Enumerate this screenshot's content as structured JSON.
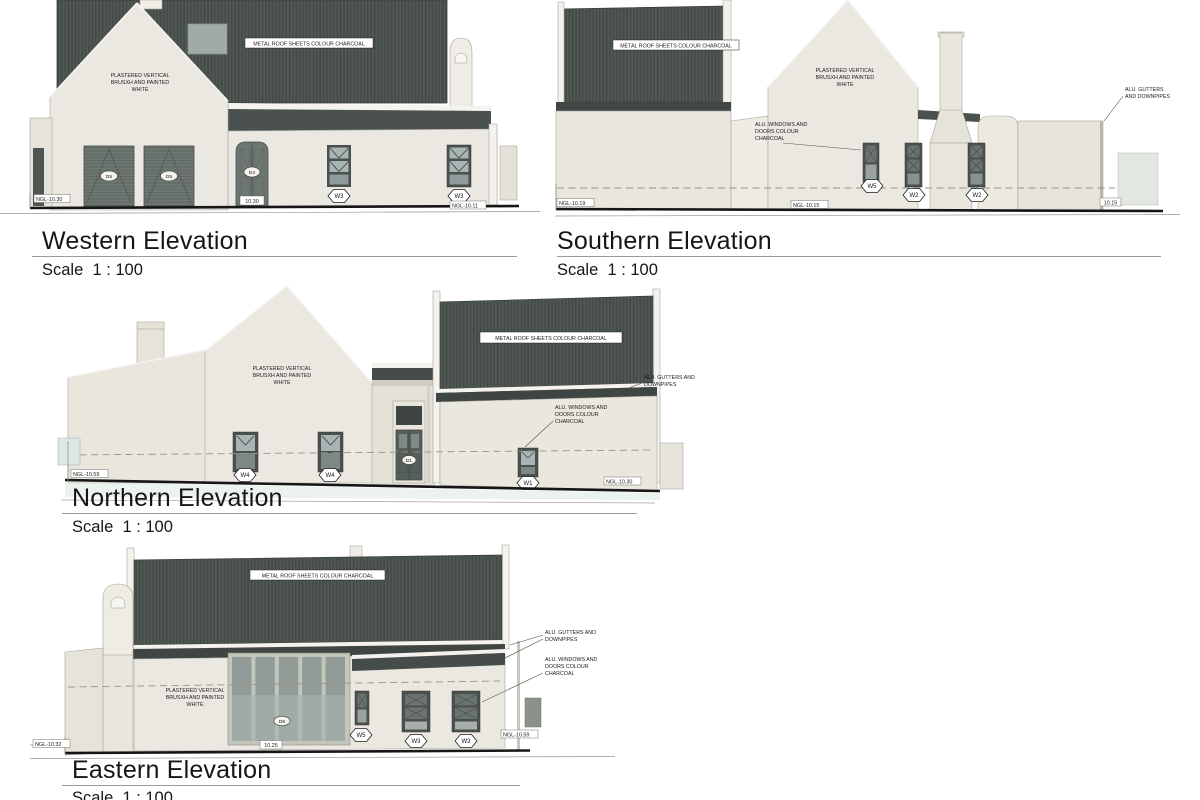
{
  "page": {
    "background": "#ffffff"
  },
  "palette": {
    "roof": "#4d5450",
    "roof_rib": "#404744",
    "eave": "#3f4542",
    "wall": "#ebe8e1",
    "wall_light": "#f3f2ec",
    "wall_shade": "#e3e0d7",
    "frame": "#49504d",
    "door_gray": "#6e7672",
    "glass_light": "#a9b4b4",
    "glass_dark": "#6a7370",
    "skylight": "#9faca5",
    "ground_line": "#161616",
    "ground_tint": "#d9e7e0"
  },
  "elevations": {
    "western": {
      "title": "Western Elevation",
      "scale_label": "Scale  1 : 100",
      "roof_note": "METAL ROOF SHEETS COLOUR CHARCOAL",
      "wall_note": [
        "PLASTERED VERTICAL",
        "BRUSXH AND PAINTED",
        "WHITE"
      ],
      "tags": {
        "garage_left": "D5",
        "garage_right": "D5",
        "door": "D4",
        "door_level": "10.30",
        "window_left": "W3",
        "window_right": "W3"
      },
      "levels": {
        "left": "NGL-10.30",
        "right": "NGL-10.11"
      }
    },
    "southern": {
      "title": "Southern Elevation",
      "scale_label": "Scale  1 : 100",
      "roof_note": "METAL ROOF SHEETS COLOUR CHARCOAL",
      "windows_note": [
        "ALU. WINDOWS AND",
        "DOORS COLOUR",
        "CHARCOAL"
      ],
      "wall_note": [
        "PLASTERED VERTICAL",
        "BRUSXH AND PAINTED",
        "WHITE"
      ],
      "gutters_note": [
        "ALU. GUTTERS",
        "AND DOWNPIPES"
      ],
      "tags": {
        "w5": "W5",
        "w2_left": "W2",
        "w2_right": "W2"
      },
      "levels": {
        "left": "NGL-10.19",
        "mid": "NGL-10.15",
        "right": "10.15"
      }
    },
    "northern": {
      "title": "Northern Elevation",
      "scale_label": "Scale  1 : 100",
      "roof_note": "METAL ROOF SHEETS COLOUR CHARCOAL",
      "wall_note": [
        "PLASTERED VERTICAL",
        "BRUSXH AND PAINTED",
        "WHITE"
      ],
      "gutters_note": [
        "ALU. GUTTERS AND",
        "DOWNPIPES"
      ],
      "windows_note": [
        "ALU. WINDOWS AND",
        "DOORS COLOUR",
        "CHARCOAL"
      ],
      "tags": {
        "w4_left": "W4",
        "w4_right": "W4",
        "door": "D1",
        "w1": "W1"
      },
      "levels": {
        "left": "NGL-10.59",
        "right": "NGL-10.30"
      }
    },
    "eastern": {
      "title": "Eastern Elevation",
      "scale_label": "Scale  1 : 100",
      "roof_note": "METAL ROOF SHEETS COLOUR CHARCOAL",
      "wall_note": [
        "PLASTERED VERTICAL",
        "BRUSXH AND PAINTED",
        "WHITE"
      ],
      "gutters_note": [
        "ALU. GUTTERS AND",
        "DOWNPIPES"
      ],
      "windows_note": [
        "ALU. WINDOWS AND",
        "DOORS COLOUR",
        "CHARCOAL"
      ],
      "tags": {
        "door": "D6",
        "door_level": "10.25",
        "w5": "W5",
        "w3_left": "W3",
        "w3_right": "W3"
      },
      "levels": {
        "left": "NGL-10.32",
        "right": "NGL-10.59"
      }
    }
  }
}
